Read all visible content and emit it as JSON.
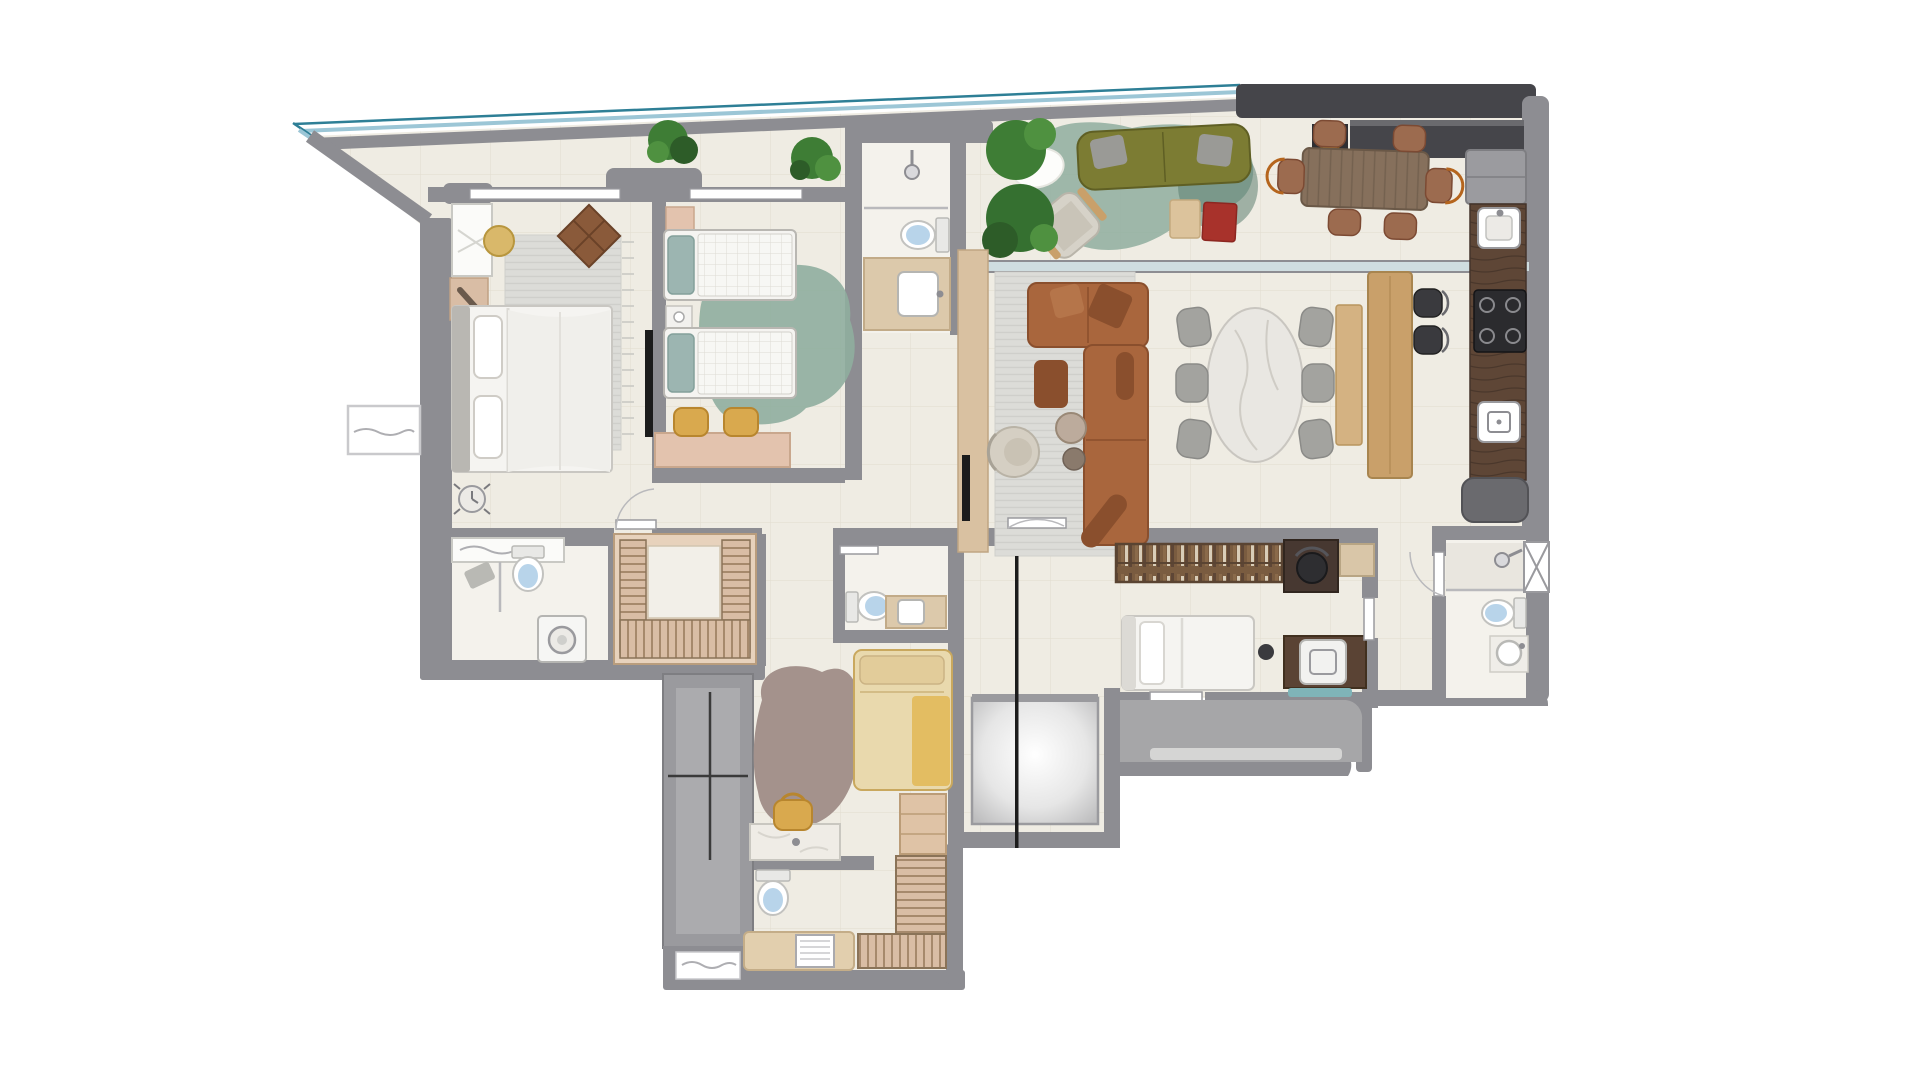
{
  "title": "apartment-floor-plan-top-view",
  "palette": {
    "background": "#ffffff",
    "floor": "#efece3",
    "floor_bright": "#f4f2ec",
    "tile_line": "#e3ded2",
    "wall": "#8d8d92",
    "wall_dark": "#45454a",
    "wall_light": "#ababae",
    "glass_teal": "#2e7f96",
    "glass_blue": "#9cc6d6",
    "balcony_floor": "#a6a6a8",
    "rug_gray": "#dcdcd8",
    "rug_stripe": "#cfcfcb",
    "rug_teal": "#8fae9f",
    "rug_teal_dark": "#5c8071",
    "rug_taupe": "#a4928c",
    "sofa_olive": "#7c7c33",
    "leather": "#a9663d",
    "leather_dark": "#8a4f2d",
    "wood_light": "#c9a06a",
    "wood_tan": "#d9bda5",
    "wood_table": "#86705c",
    "counter_brown": "#5e4636",
    "stove_black": "#2b2b2e",
    "marble": "#e9e7e2",
    "bed_white": "#f5f4f1",
    "pillow_teal": "#9cb5b1",
    "mustard": "#d9a94e",
    "accent_red": "#a8322b",
    "plant_green": "#3e7d35",
    "plant_dark": "#2d5c28",
    "chair_gray": "#a3a39f",
    "water_blue": "#b8d4ea",
    "bed_yellow": "#e9d9ad",
    "blanket_yellow": "#e3bd62"
  },
  "plan": {
    "rooms": [
      {
        "id": "terrace",
        "furniture": {
          "plants": 3,
          "olive_sofa": 1,
          "gray_pillows": 2,
          "organic_teal_rug": 1,
          "lounge_armchair": 1,
          "side_tables": 2,
          "sheepskin_rug": 1
        }
      },
      {
        "id": "gourmet-terrace",
        "furniture": {
          "dining_table": 1,
          "chairs": 6,
          "grill_counter": 1,
          "counter_sink": 1
        }
      },
      {
        "id": "master-bedroom",
        "furniture": {
          "double_bed": 1,
          "rug": 1,
          "wardrobe_cabinet": 1,
          "nightstand": 1,
          "stool": 1,
          "wall_tv": 1,
          "kite_wall_decor": 1,
          "clock": 1
        }
      },
      {
        "id": "bedroom-2",
        "furniture": {
          "twin_beds": 2,
          "teal_pillows": 2,
          "nightstand": 1,
          "organic_teal_rug": 1,
          "desk": 1,
          "mustard_chairs": 2,
          "wardrobe": 1
        }
      },
      {
        "id": "bathroom-social",
        "furniture": {
          "shower": 1,
          "toilet": 1,
          "vanity_sink": 1
        }
      },
      {
        "id": "master-bathroom",
        "furniture": {
          "vanity_mirror": 1,
          "toilet": 1,
          "washer": 1,
          "bath_mat": 1
        }
      },
      {
        "id": "walk-in-closet",
        "furniture": {
          "u_shaped_wardrobe": 1
        }
      },
      {
        "id": "living-room",
        "furniture": {
          "tv_panel": 1,
          "striped_rug": 1,
          "leather_sectional": 1,
          "ottoman": 1,
          "round_tables": 2,
          "boucle_armchair": 1,
          "oval_marble_table": 1,
          "dining_chairs": 6
        }
      },
      {
        "id": "kitchen",
        "furniture": {
          "island_counter": 1,
          "bar_stools": 2,
          "fridge": 1,
          "sink": 1,
          "cooktop": 1,
          "dishwasher": 1,
          "counter_run": 1
        }
      },
      {
        "id": "bathroom-3",
        "furniture": {
          "toilet": 1,
          "vanity_sink": 1
        }
      },
      {
        "id": "service-room",
        "furniture": {
          "bookshelf": 1,
          "desk": 1,
          "office_chair": 1,
          "single_bed": 1,
          "washer_cabinet": 1
        }
      },
      {
        "id": "service-balcony",
        "furniture": {
          "sill": 1
        }
      },
      {
        "id": "elevator-core",
        "furniture": {
          "elevator_car": 1,
          "stair_shaft": 1,
          "section_line": 1
        }
      },
      {
        "id": "service-suite",
        "furniture": {
          "single_bed": 1,
          "organic_rug": 1,
          "vanity": 1,
          "tote_bag": 1,
          "cabinet": 1
        }
      },
      {
        "id": "bathroom-4",
        "furniture": {
          "toilet": 1,
          "bathtub": 1,
          "fixture_panel": 1
        }
      },
      {
        "id": "closet-2",
        "furniture": {
          "shelving": 2
        }
      },
      {
        "id": "bathroom-right",
        "furniture": {
          "shower": 1,
          "toilet": 1,
          "round_sink": 1,
          "hatched_window": 1
        }
      }
    ]
  }
}
